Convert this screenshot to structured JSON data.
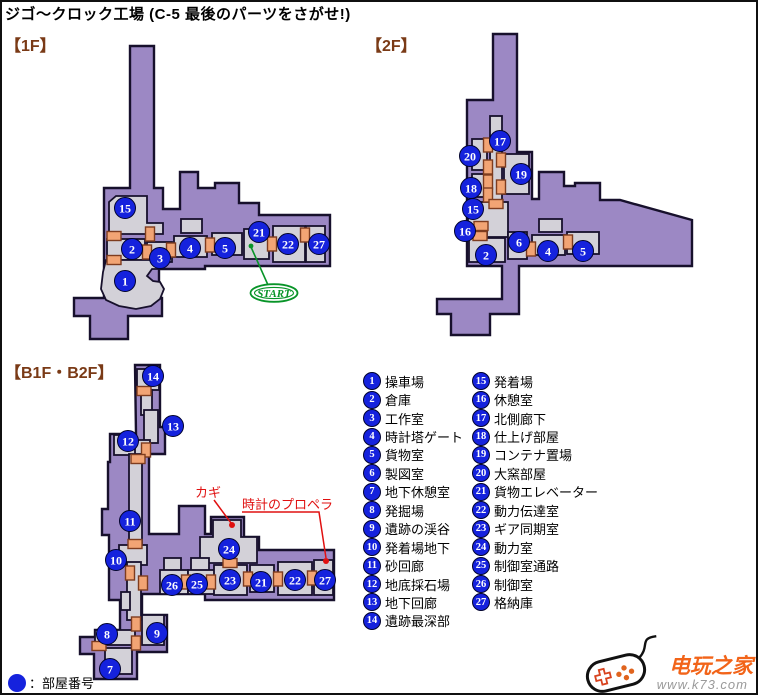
{
  "title": "ジゴ～クロック工場 (C-5 最後のパーツをさがせ!)",
  "sections": {
    "f1": "【1F】",
    "f2": "【2F】",
    "b1f": "【B1F・B2F】"
  },
  "colors": {
    "map_purple": "#9c88c4",
    "room_gray": "#d3d1d8",
    "outline": "#17102c",
    "door_fill": "#f2a474",
    "door_border": "#7e3c1f",
    "badge_blue": "#1522dd",
    "annotation_red": "#e01010",
    "start_green": "#089428",
    "header_brown": "#7a3a16",
    "brand_orange": "#f26419"
  },
  "legend": {
    "columns": [
      [
        {
          "n": "1",
          "label": "操車場"
        },
        {
          "n": "2",
          "label": "倉庫"
        },
        {
          "n": "3",
          "label": "工作室"
        },
        {
          "n": "4",
          "label": "時計塔ゲート"
        },
        {
          "n": "5",
          "label": "貨物室"
        },
        {
          "n": "6",
          "label": "製図室"
        },
        {
          "n": "7",
          "label": "地下休憩室"
        },
        {
          "n": "8",
          "label": "発掘場"
        },
        {
          "n": "9",
          "label": "遺跡の渓谷"
        },
        {
          "n": "10",
          "label": "発着場地下"
        },
        {
          "n": "11",
          "label": "砂回廊"
        },
        {
          "n": "12",
          "label": "地底採石場"
        },
        {
          "n": "13",
          "label": "地下回廊"
        },
        {
          "n": "14",
          "label": "遺跡最深部"
        }
      ],
      [
        {
          "n": "15",
          "label": "発着場"
        },
        {
          "n": "16",
          "label": "休憩室"
        },
        {
          "n": "17",
          "label": "北側廊下"
        },
        {
          "n": "18",
          "label": "仕上げ部屋"
        },
        {
          "n": "19",
          "label": "コンテナ置場"
        },
        {
          "n": "20",
          "label": "大窯部屋"
        },
        {
          "n": "21",
          "label": "貨物エレベーター"
        },
        {
          "n": "22",
          "label": "動力伝達室"
        },
        {
          "n": "23",
          "label": "ギア同期室"
        },
        {
          "n": "24",
          "label": "動力室"
        },
        {
          "n": "25",
          "label": "制御室通路"
        },
        {
          "n": "26",
          "label": "制御室"
        },
        {
          "n": "27",
          "label": "格納庫"
        }
      ]
    ],
    "footer_label": "：部屋番号"
  },
  "maps": {
    "f1": {
      "start_label": "START",
      "markers": [
        {
          "n": "15",
          "x": 123,
          "y": 206
        },
        {
          "n": "2",
          "x": 130,
          "y": 247
        },
        {
          "n": "3",
          "x": 158,
          "y": 256
        },
        {
          "n": "1",
          "x": 123,
          "y": 279
        },
        {
          "n": "4",
          "x": 188,
          "y": 246
        },
        {
          "n": "5",
          "x": 223,
          "y": 246
        },
        {
          "n": "21",
          "x": 257,
          "y": 230
        },
        {
          "n": "22",
          "x": 286,
          "y": 242
        },
        {
          "n": "27",
          "x": 317,
          "y": 242
        }
      ],
      "doors": [
        {
          "x": 112,
          "y": 234,
          "o": "h"
        },
        {
          "x": 148,
          "y": 232,
          "o": "v"
        },
        {
          "x": 112,
          "y": 258,
          "o": "h"
        },
        {
          "x": 145,
          "y": 250,
          "o": "v"
        },
        {
          "x": 169,
          "y": 248,
          "o": "v"
        },
        {
          "x": 208,
          "y": 243,
          "o": "v"
        },
        {
          "x": 270,
          "y": 242,
          "o": "v"
        },
        {
          "x": 303,
          "y": 233,
          "o": "v"
        }
      ]
    },
    "f2": {
      "markers": [
        {
          "n": "17",
          "x": 498,
          "y": 139
        },
        {
          "n": "20",
          "x": 468,
          "y": 154
        },
        {
          "n": "19",
          "x": 519,
          "y": 172
        },
        {
          "n": "18",
          "x": 469,
          "y": 186
        },
        {
          "n": "15",
          "x": 471,
          "y": 207
        },
        {
          "n": "16",
          "x": 463,
          "y": 229
        },
        {
          "n": "2",
          "x": 484,
          "y": 253
        },
        {
          "n": "6",
          "x": 517,
          "y": 240
        },
        {
          "n": "4",
          "x": 546,
          "y": 249
        },
        {
          "n": "5",
          "x": 581,
          "y": 249
        }
      ],
      "doors": [
        {
          "x": 486,
          "y": 143,
          "o": "v"
        },
        {
          "x": 486,
          "y": 165,
          "o": "v"
        },
        {
          "x": 486,
          "y": 180,
          "o": "v"
        },
        {
          "x": 486,
          "y": 193,
          "o": "v"
        },
        {
          "x": 499,
          "y": 158,
          "o": "v"
        },
        {
          "x": 499,
          "y": 185,
          "o": "v"
        },
        {
          "x": 494,
          "y": 202,
          "o": "h"
        },
        {
          "x": 479,
          "y": 224,
          "o": "h"
        },
        {
          "x": 478,
          "y": 234,
          "o": "h"
        },
        {
          "x": 529,
          "y": 247,
          "o": "v"
        },
        {
          "x": 566,
          "y": 240,
          "o": "v"
        }
      ]
    },
    "b1f": {
      "markers": [
        {
          "n": "14",
          "x": 151,
          "y": 374
        },
        {
          "n": "13",
          "x": 171,
          "y": 424
        },
        {
          "n": "12",
          "x": 126,
          "y": 439
        },
        {
          "n": "11",
          "x": 128,
          "y": 519
        },
        {
          "n": "10",
          "x": 114,
          "y": 558
        },
        {
          "n": "8",
          "x": 105,
          "y": 632
        },
        {
          "n": "9",
          "x": 155,
          "y": 631
        },
        {
          "n": "7",
          "x": 108,
          "y": 667
        },
        {
          "n": "24",
          "x": 227,
          "y": 547
        },
        {
          "n": "26",
          "x": 170,
          "y": 583
        },
        {
          "n": "25",
          "x": 195,
          "y": 582
        },
        {
          "n": "23",
          "x": 228,
          "y": 578
        },
        {
          "n": "21",
          "x": 259,
          "y": 580
        },
        {
          "n": "22",
          "x": 293,
          "y": 578
        },
        {
          "n": "27",
          "x": 323,
          "y": 578
        }
      ],
      "doors": [
        {
          "x": 142,
          "y": 389,
          "o": "h"
        },
        {
          "x": 144,
          "y": 448,
          "o": "v"
        },
        {
          "x": 136,
          "y": 457,
          "o": "h"
        },
        {
          "x": 133,
          "y": 542,
          "o": "h"
        },
        {
          "x": 128,
          "y": 571,
          "o": "v"
        },
        {
          "x": 141,
          "y": 581,
          "o": "v"
        },
        {
          "x": 184,
          "y": 580,
          "o": "v"
        },
        {
          "x": 209,
          "y": 580,
          "o": "v"
        },
        {
          "x": 246,
          "y": 577,
          "o": "v"
        },
        {
          "x": 276,
          "y": 577,
          "o": "v"
        },
        {
          "x": 310,
          "y": 576,
          "o": "v"
        },
        {
          "x": 228,
          "y": 561,
          "o": "h"
        },
        {
          "x": 134,
          "y": 622,
          "o": "v"
        },
        {
          "x": 134,
          "y": 641,
          "o": "v"
        },
        {
          "x": 97,
          "y": 644,
          "o": "h"
        }
      ],
      "annotations": [
        {
          "text": "カギ"
        },
        {
          "text": "時計のプロペラ"
        }
      ]
    }
  },
  "watermark": {
    "brand": "电玩之家",
    "url": "www.k73.com"
  }
}
